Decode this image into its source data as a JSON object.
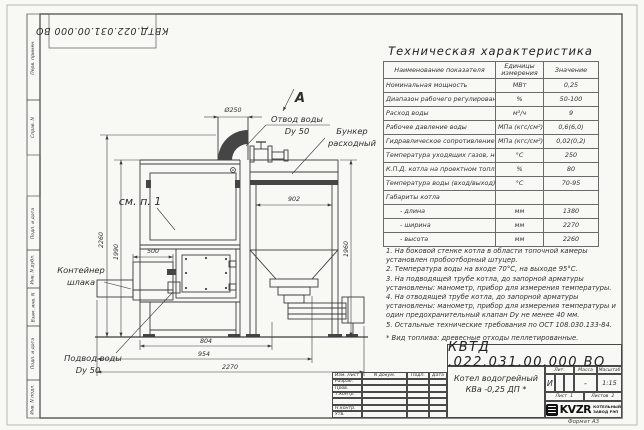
{
  "stamp_top": {
    "doc_number": "КВТД.022.031.00.000 ВО"
  },
  "side_labels": [
    "Перв. примен.",
    "Справ. N",
    "Подп. и дата",
    "Инв. N дубл.",
    "Взам. инв. N",
    "Подп. и дата",
    "Инв. N подл."
  ],
  "drawing": {
    "section_label": "А",
    "see_note": "см. п. 1",
    "callouts": {
      "water_outlet_1": "Отвод воды",
      "water_outlet_2": "Dy 50",
      "hopper_1": "Бункер",
      "hopper_2": "расходный",
      "slag_1": "Контейнер",
      "slag_2": "шлака",
      "water_inlet_1": "Подвод воды",
      "water_inlet_2": "Dy 50"
    },
    "dims": {
      "chimney": "Ø250",
      "height_total": "2260",
      "height_body": "1990",
      "container_width": "500",
      "hopper_width": "902",
      "hopper_height": "1960",
      "width_boiler": "804",
      "width_mid": "954",
      "width_total": "2270"
    }
  },
  "spec_table": {
    "title": "Техническая характеристика",
    "col_name": "Наименование показателя",
    "col_units_1": "Единицы",
    "col_units_2": "измерения",
    "col_value": "Значение",
    "rows": [
      {
        "name": "Номинальная мощность",
        "units": "МВт",
        "value": "0,25"
      },
      {
        "name": "Диапазон рабочего регулирования",
        "units": "%",
        "value": "50-100"
      },
      {
        "name": "Расход воды",
        "units": "м³/ч",
        "value": "9"
      },
      {
        "name": "Рабочее давление воды",
        "units": "МПа (кгс/см²)",
        "value": "0,6(6,0)"
      },
      {
        "name": "Гидравлическое сопротивление котла",
        "units": "МПа (кгс/см²)",
        "value": "0,02(0,2)"
      },
      {
        "name": "Температура уходящих газов, не более",
        "units": "°С",
        "value": "250"
      },
      {
        "name": "К.П.Д. котла на проектном топливе",
        "units": "%",
        "value": "80"
      },
      {
        "name": "Температура воды (вход/выход)",
        "units": "°С",
        "value": "70-95"
      },
      {
        "name": "Габариты котла",
        "units": "",
        "value": ""
      },
      {
        "name": "- длина",
        "units": "мм",
        "value": "1380"
      },
      {
        "name": "- ширина",
        "units": "мм",
        "value": "2270"
      },
      {
        "name": "- высота",
        "units": "мм",
        "value": "2260"
      }
    ]
  },
  "notes": [
    "1. На боковой стенке котла в области топочной камеры установлен пробоотборный штуцер.",
    "2. Температура воды на входе 70°С, на выходе 95°С.",
    "3. На подводящей трубе котла, до запорной арматуры установлены: манометр, прибор для измерения температуры.",
    "4. На отводящей трубе котла, до запорной арматуры установлены: манометр, прибор для измерения температуры и один предохранительный клапан Dу не менее 40 мм.",
    "5. Остальные технические требования по ОСТ 108.030.133-84.",
    "* Вид топлива: древесные отходы пеллетированные."
  ],
  "title_block": {
    "doc_number": "КВТД .022.031.00.000 ВО",
    "product_1": "Котел водогрейный",
    "product_2": "КВа -0,25 ДП *",
    "col_izm": "Изм. Лист",
    "col_doc": "N докум.",
    "col_sign": "Подп.",
    "col_date": "Дата",
    "row_labels": [
      "Разраб.",
      "Пров.",
      "Т.контр.",
      "",
      "Н.контр.",
      "Утв."
    ],
    "lit_label": "Лит.",
    "mass_label": "Масса",
    "scale_label": "Масштаб",
    "lit_value": "И",
    "mass_value": "-",
    "scale_value": "1:15",
    "sheet_label": "Лист",
    "sheet_value": "1",
    "sheets_label": "Листов",
    "sheets_value": "2",
    "logo_text": "KVZR",
    "logo_sub_1": "КОТЕЛЬНЫЙ",
    "logo_sub_2": "ЗАВОД РЭП",
    "format_note": "Формат А3"
  }
}
